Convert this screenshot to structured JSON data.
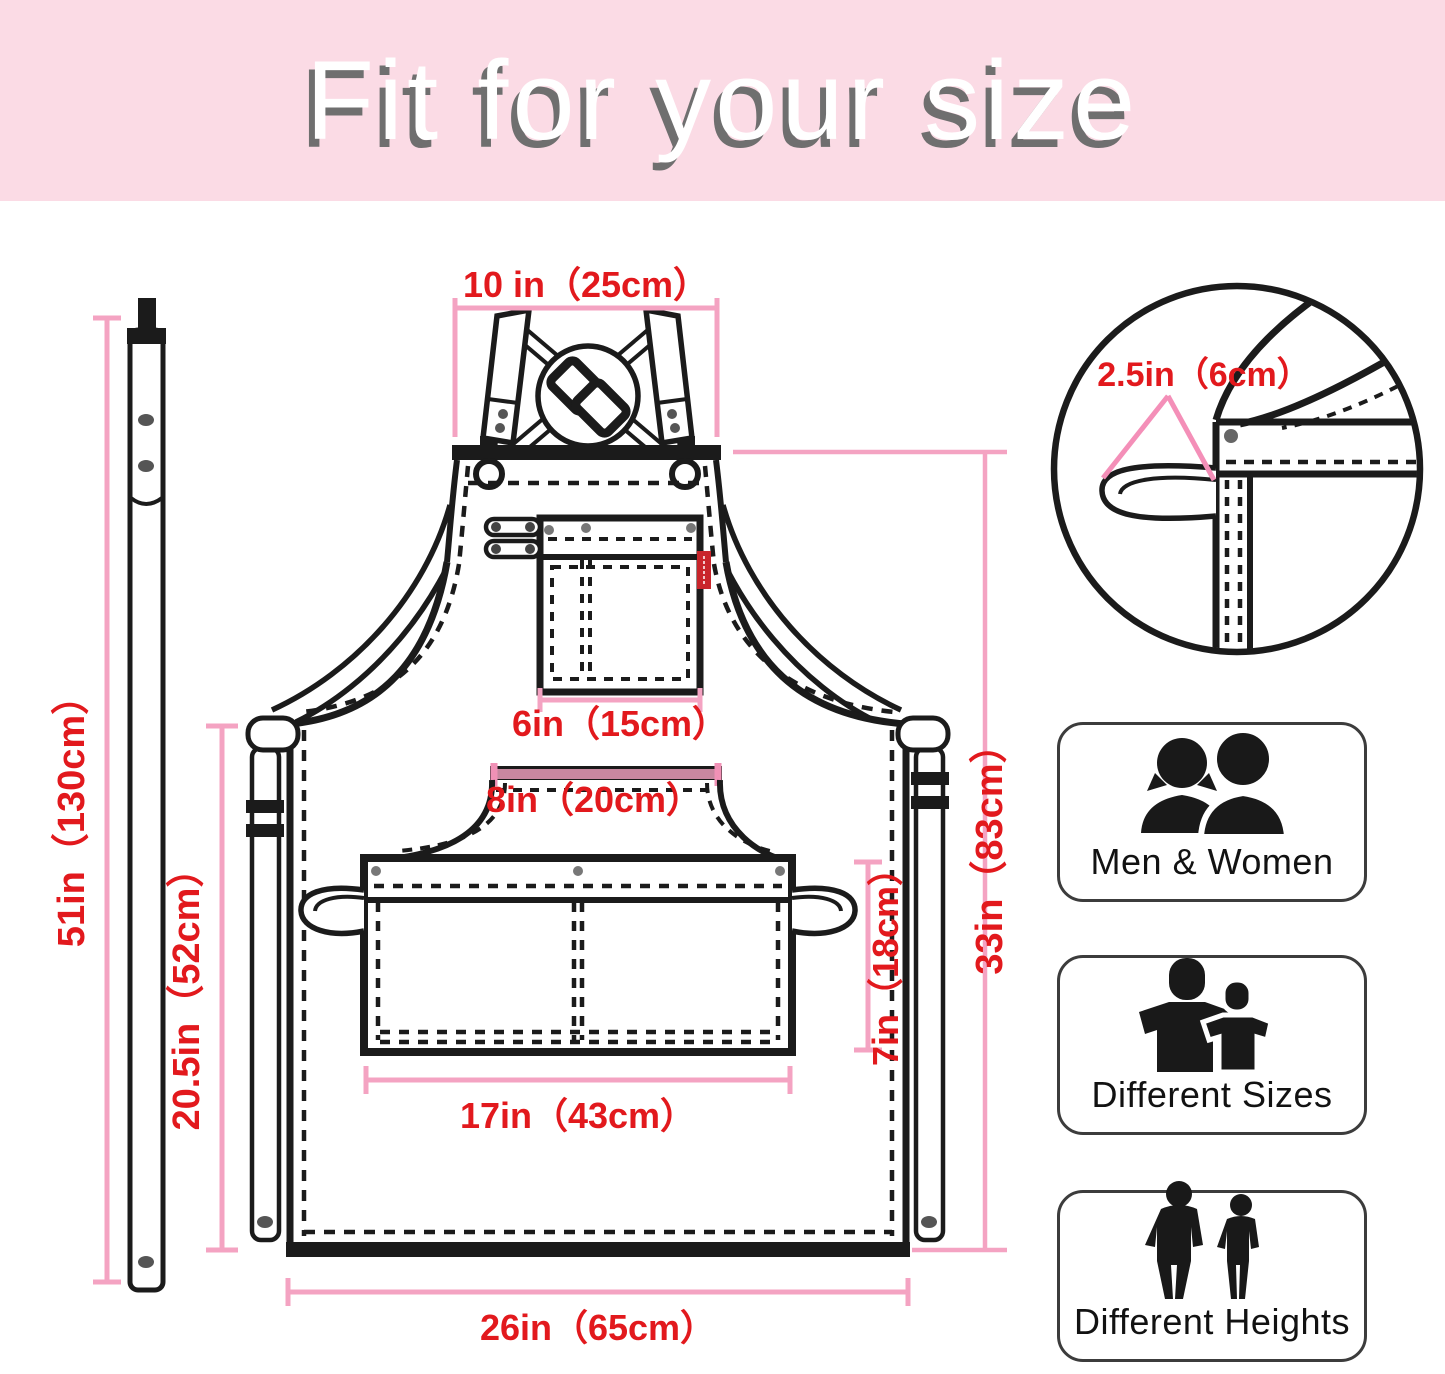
{
  "banner": {
    "title": "Fit for your size",
    "background": "#fbdbe5",
    "text_color": "#ffffff",
    "shadow_color": "#6f6f6f"
  },
  "colors": {
    "measurement_text_red": "#e2191d",
    "dimension_line_pink": "#f4a3c2",
    "callout_triangle_pink": "#f48fb8",
    "line_art_ink": "#1b1b1b",
    "brand_tag_red": "#c9252b"
  },
  "diagram": {
    "measurements": {
      "neck_strap_length": "51in（130cm）",
      "top_strap_width": "10 in（25cm）",
      "loop_width": "2.5in（6cm）",
      "chest_pocket_width": "6in（15cm）",
      "waist_panel_width": "8in（20cm）",
      "side_height": "20.5in（52cm）",
      "front_pocket_height": "7in（18cm）",
      "front_pocket_width": "17in（43cm）",
      "apron_height": "33in（83cm）",
      "bottom_width": "26in（65cm）"
    }
  },
  "features": [
    {
      "label": "Men & Women",
      "icon": "men-women-icon"
    },
    {
      "label": "Different Sizes",
      "icon": "different-sizes-icon"
    },
    {
      "label": "Different Heights",
      "icon": "different-heights-icon"
    }
  ]
}
